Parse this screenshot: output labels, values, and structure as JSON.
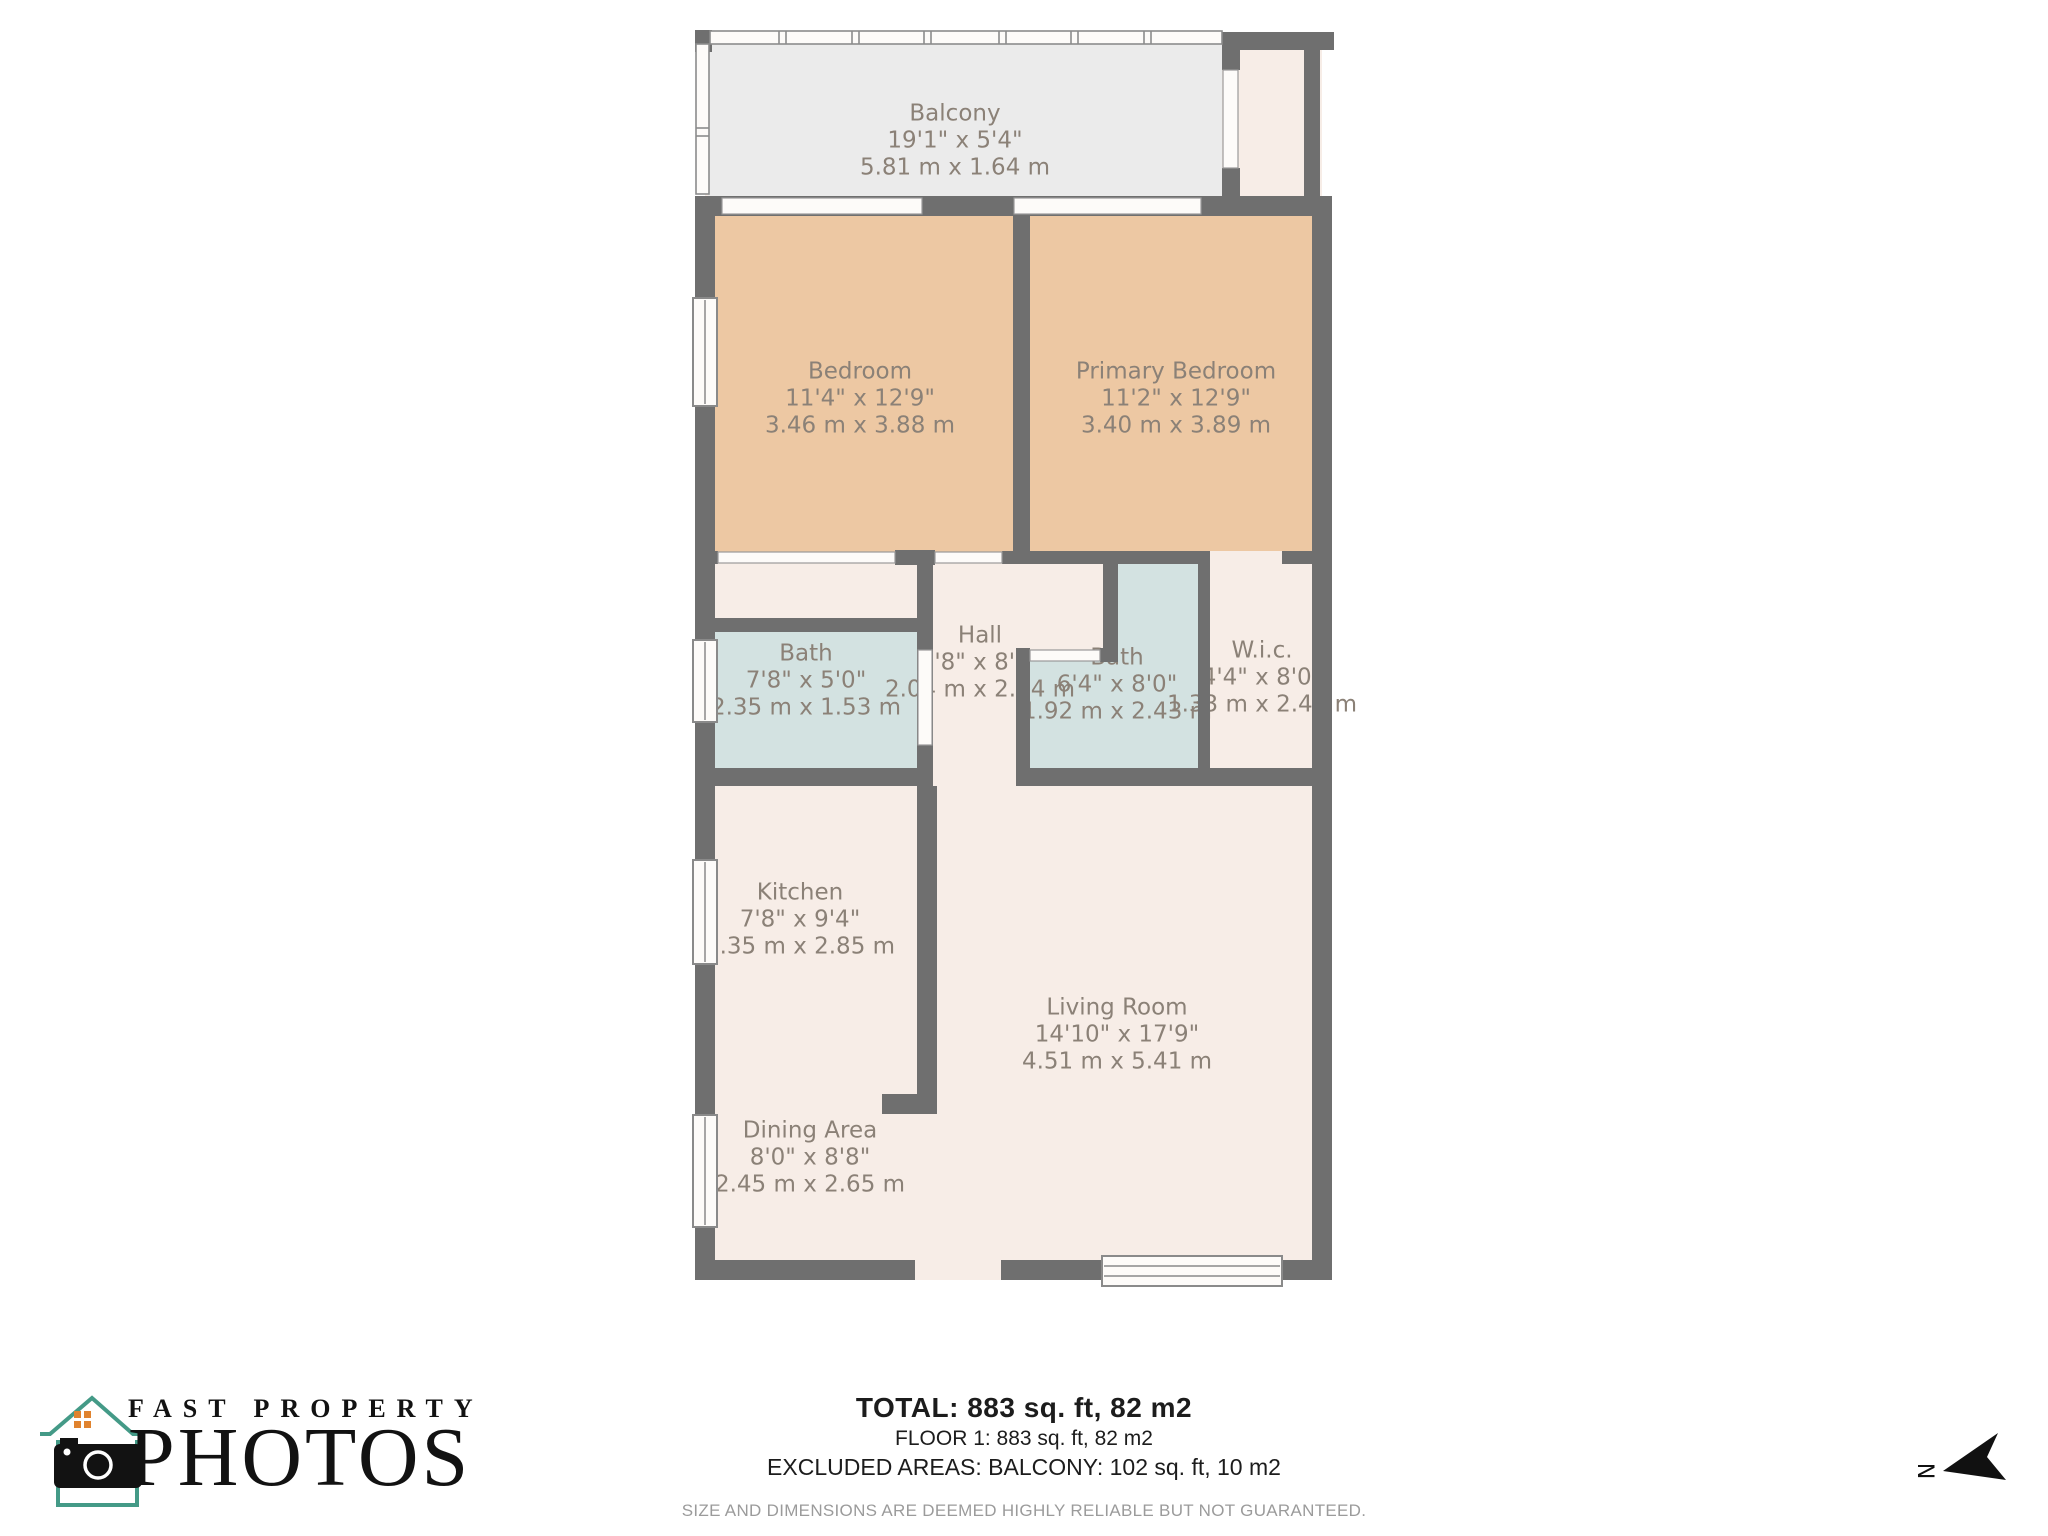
{
  "plan": {
    "rooms": [
      {
        "id": "balcony",
        "name": "Balcony",
        "imperial": "19'1\" x 5'4\"",
        "metric": "5.81 m x 1.64 m"
      },
      {
        "id": "bedroom",
        "name": "Bedroom",
        "imperial": "11'4\" x 12'9\"",
        "metric": "3.46 m x 3.88 m"
      },
      {
        "id": "primary-bedroom",
        "name": "Primary Bedroom",
        "imperial": "11'2\" x 12'9\"",
        "metric": "3.40 m x 3.89 m"
      },
      {
        "id": "bath-1",
        "name": "Bath",
        "imperial": "7'8\" x 5'0\"",
        "metric": "2.35 m x 1.53 m"
      },
      {
        "id": "hall",
        "name": "Hall",
        "imperial": "6'8\" x 8'4\"",
        "metric": "2.04 m x 2.54 m"
      },
      {
        "id": "bath-2",
        "name": "Bath",
        "imperial": "6'4\" x 8'0\"",
        "metric": "1.92 m x 2.43 m"
      },
      {
        "id": "wic",
        "name": "W.i.c.",
        "imperial": "4'4\" x 8'0\"",
        "metric": "1.33 m x 2.43 m"
      },
      {
        "id": "kitchen",
        "name": "Kitchen",
        "imperial": "7'8\" x 9'4\"",
        "metric": "2.35 m x 2.85 m"
      },
      {
        "id": "living-room",
        "name": "Living Room",
        "imperial": "14'10\" x 17'9\"",
        "metric": "4.51 m x 5.41 m"
      },
      {
        "id": "dining-area",
        "name": "Dining Area",
        "imperial": "8'0\" x 8'8\"",
        "metric": "2.45 m x 2.65 m"
      }
    ],
    "colors": {
      "wall": "#6f6f6f",
      "floor": "#f7ede7",
      "bedroom_fill": "#edc8a3",
      "bath_fill": "#d3e2e1",
      "balcony_fill": "#ebebeb",
      "label_text": "#8b8177"
    }
  },
  "footer": {
    "total": "TOTAL: 883 sq. ft, 82 m2",
    "floor": "FLOOR 1: 883 sq. ft, 82 m2",
    "excluded": "EXCLUDED AREAS: BALCONY: 102 sq. ft, 10 m2",
    "disclaimer": "SIZE AND DIMENSIONS ARE DEEMED HIGHLY RELIABLE BUT NOT GUARANTEED."
  },
  "logo": {
    "line1": "FAST PROPERTY",
    "line2": "PHOTOS",
    "teal": "#449a87",
    "orange": "#e0832e"
  },
  "compass": {
    "label": "N"
  }
}
